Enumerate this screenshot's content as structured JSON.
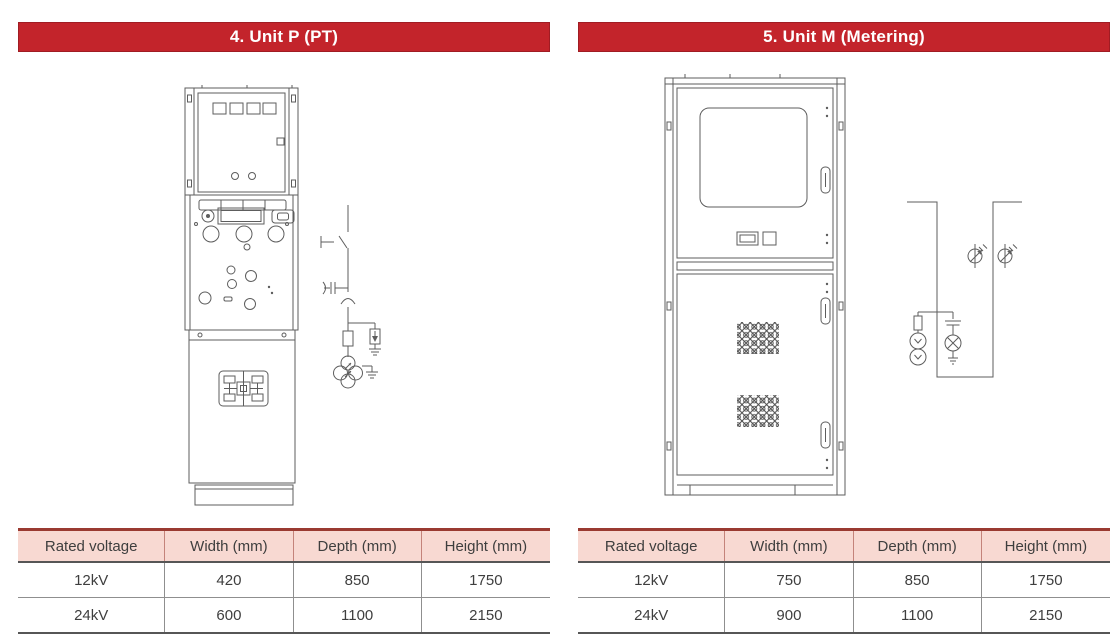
{
  "colors": {
    "banner_red": "#c3242b",
    "banner_border": "#a01c23",
    "table_header_bg": "#f8d9d2",
    "table_top_border": "#9a3a31",
    "header_divider": "#c4837a",
    "line_dark": "#565656",
    "line_gray": "#8f8f8f",
    "drawing_stroke": "#5d5d5d"
  },
  "panels": {
    "unit_p": {
      "title": "4. Unit P (PT)",
      "table": {
        "headers": [
          "Rated voltage",
          "Width (mm)",
          "Depth (mm)",
          "Height (mm)"
        ],
        "rows": [
          [
            "12kV",
            "420",
            "850",
            "1750"
          ],
          [
            "24kV",
            "600",
            "1100",
            "2150"
          ]
        ]
      }
    },
    "unit_m": {
      "title": "5. Unit M (Metering)",
      "table": {
        "headers": [
          "Rated voltage",
          "Width (mm)",
          "Depth (mm)",
          "Height (mm)"
        ],
        "rows": [
          [
            "12kV",
            "750",
            "850",
            "1750"
          ],
          [
            "24kV",
            "900",
            "1100",
            "2150"
          ]
        ]
      }
    }
  }
}
